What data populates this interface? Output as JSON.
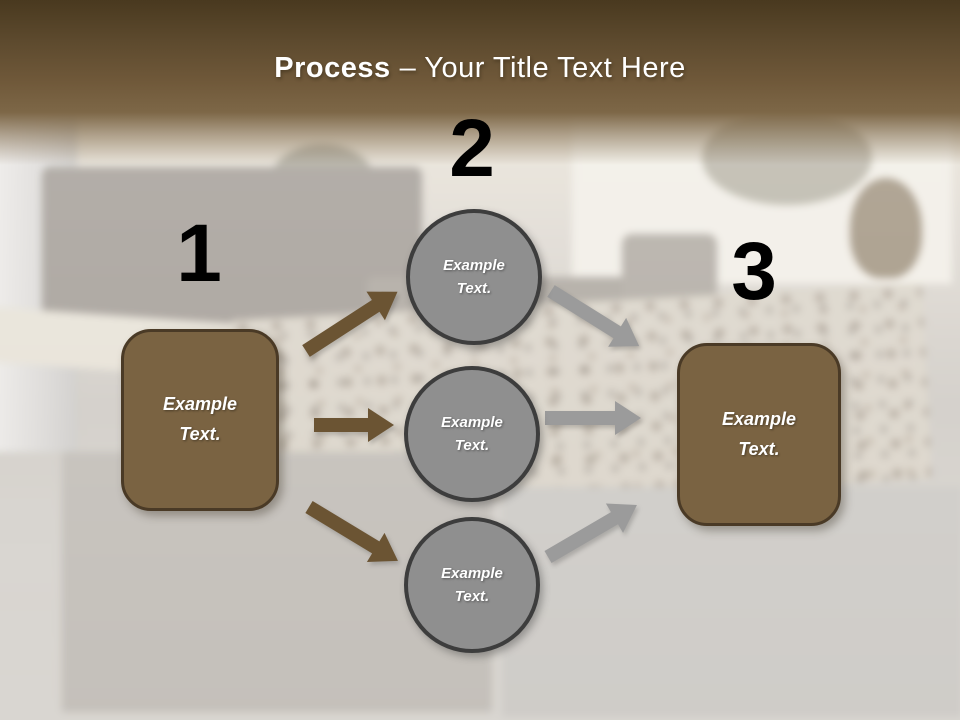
{
  "slide": {
    "header": {
      "title_bold": "Process",
      "title_rest": "– Your Title Text Here"
    },
    "step1": {
      "number": "1",
      "box_text": "Example\nText."
    },
    "step2": {
      "number": "2",
      "circles": [
        {
          "text": "Example\nText."
        },
        {
          "text": "Example\nText."
        },
        {
          "text": "Example\nText."
        }
      ]
    },
    "step3": {
      "number": "3",
      "box_text": "Example\nText."
    },
    "colors": {
      "header_top": "#49391f",
      "header_bottom": "#7d6747",
      "title_color": "#ffffff",
      "number_color": "#000000",
      "brown_shape_fill": "#7a6342",
      "brown_shape_border": "#4a3a26",
      "gray_circle_fill": "#8f8f8f",
      "gray_circle_border": "#3d3d3d",
      "arrow_brown": "#6b5433",
      "arrow_gray": "#9b9b9b"
    }
  }
}
